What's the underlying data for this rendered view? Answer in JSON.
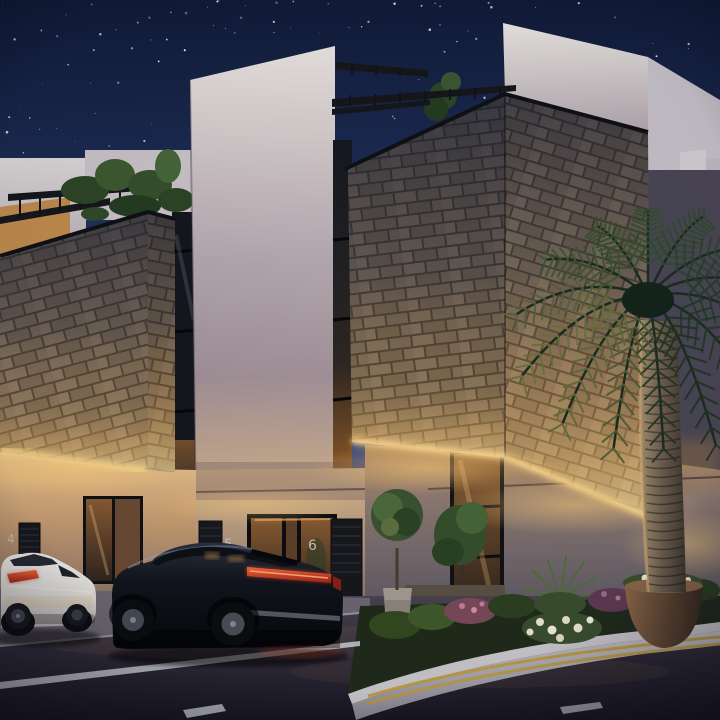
{
  "meta": {
    "title": "Night architectural rendering of modern stone-clad townhouses"
  },
  "scene": {
    "setting": "night",
    "description": "Row of modern townhouses with rough stone-clad upper volumes and white plaster walls, warm facade uplighting, black rooftop pergolas with trailing plants, a starry navy sky, street-side parked cars, corner landscaping beds and a large palm tree",
    "sky": {
      "stars_visible": true,
      "star_count": 230
    },
    "vehicles": [
      {
        "type": "white luxury fastback sedan",
        "position": "left, partially cropped at image edge"
      },
      {
        "type": "black luxury SUV",
        "position": "center, parked along the curb"
      }
    ],
    "landscaping": [
      "large palm tree at right corner",
      "potted topiary tree by entrance",
      "large bronze flower planter",
      "corner bed with shrubs, white and pink flowers",
      "rooftop pergola vines"
    ],
    "road_markings": [
      "white edge line",
      "white dashed lane line",
      "double yellow lines along corner curb"
    ]
  },
  "units": [
    {
      "number": "4"
    },
    {
      "number": "5"
    },
    {
      "number": "6"
    }
  ],
  "colors": {
    "sky_top": "#111b38",
    "sky_mid": "#223463",
    "sky_horizon": "#7f7aa3",
    "star": "#ffffff",
    "stone_light": "#9d8d74",
    "stone_mid": "#857662",
    "stone_dark": "#6a5d4c",
    "warm_light": "#ffd98f",
    "glow_amber": "#f0b45e",
    "white_wall": "#ece7e2",
    "pergola_black": "#15171b",
    "glass_warm": "#8a5c33",
    "foliage_dark": "#22391f",
    "foliage_warm": "#6e7040",
    "palm_trunk": "#8d7c66",
    "car_white": "#eceae6",
    "car_black": "#10141b",
    "taillight": "#ff6a3c",
    "road": "#2c2836",
    "line_white": "#ccd0d6",
    "line_yellow": "#c19b3c",
    "curb": "#b9b7bd",
    "number": "#c9c2ba",
    "flower_white": "#ece8d6",
    "flower_pink": "#cf8fae"
  }
}
